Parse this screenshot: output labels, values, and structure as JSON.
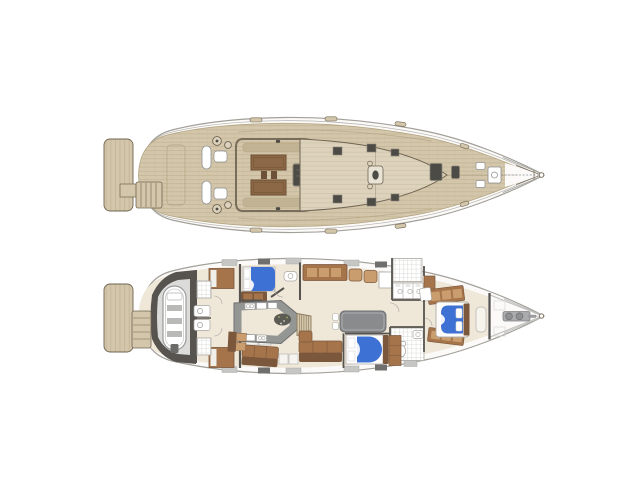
{
  "canvas": {
    "background": "#ffffff"
  },
  "colors": {
    "hullline": "#a3a09a",
    "hullfill": "#fbfaf8",
    "teak": "#d3c6aa",
    "teakl": "#ddd3bd",
    "teakd": "#c2b394",
    "plank": "#b2a380",
    "trim": "#6f6452",
    "hatch": "#4d4b46",
    "white": "#ffffff",
    "metal": "#8f9092",
    "tablewood": "#8c6847",
    "tablewooddark": "#6e5036",
    "cream": "#efe7d8",
    "wall": "#57544f",
    "wood": "#a5744b",
    "wooddark": "#7b573c",
    "woodlight": "#c99d6d",
    "counter": "#949694",
    "tablegray": "#898b8d",
    "blue": "#3e71d4",
    "tileline": "#d9d9d7",
    "garagefloor": "#dbdbd9",
    "band": "#8d8d8b",
    "bandlight": "#c6c6c4",
    "seatgray": "#b9bab7",
    "speckle": "#4c4c46"
  },
  "views": {
    "deck_plan": {
      "parts": [
        "swim-platform",
        "transom-steps",
        "aft-deck",
        "helm-stations",
        "helm-seats",
        "winches",
        "guest-cockpit",
        "cockpit-benches",
        "cockpit-table",
        "companionway-hatch",
        "coachroof",
        "deck-hatches",
        "mast",
        "foredeck-hatches",
        "anchor-windlass",
        "bow-cleats",
        "bow-pulpit",
        "bowsprit-tip"
      ]
    },
    "interior_plan": {
      "parts": [
        "swim-platform",
        "transom-steps",
        "tender-garage",
        "dinghy",
        "outboard-motor",
        "crew-bunks",
        "crew-showers",
        "crew-sinks",
        "aft-cabin-port-bed",
        "aft-wardrobe",
        "vanity",
        "aft-berth-starboard",
        "galley-island",
        "galley-appliances",
        "companionway-stairs",
        "salon-sideboard",
        "armchairs",
        "dining-table",
        "salon-sofa",
        "head-port-shower",
        "head-port-vanity",
        "bathroom-starboard",
        "toilet",
        "mid-cabin-bed",
        "owner-cabin-bed",
        "owner-lockers",
        "forepeak-sail-locker",
        "anchor-windlass",
        "bowsprit-tip"
      ]
    }
  }
}
